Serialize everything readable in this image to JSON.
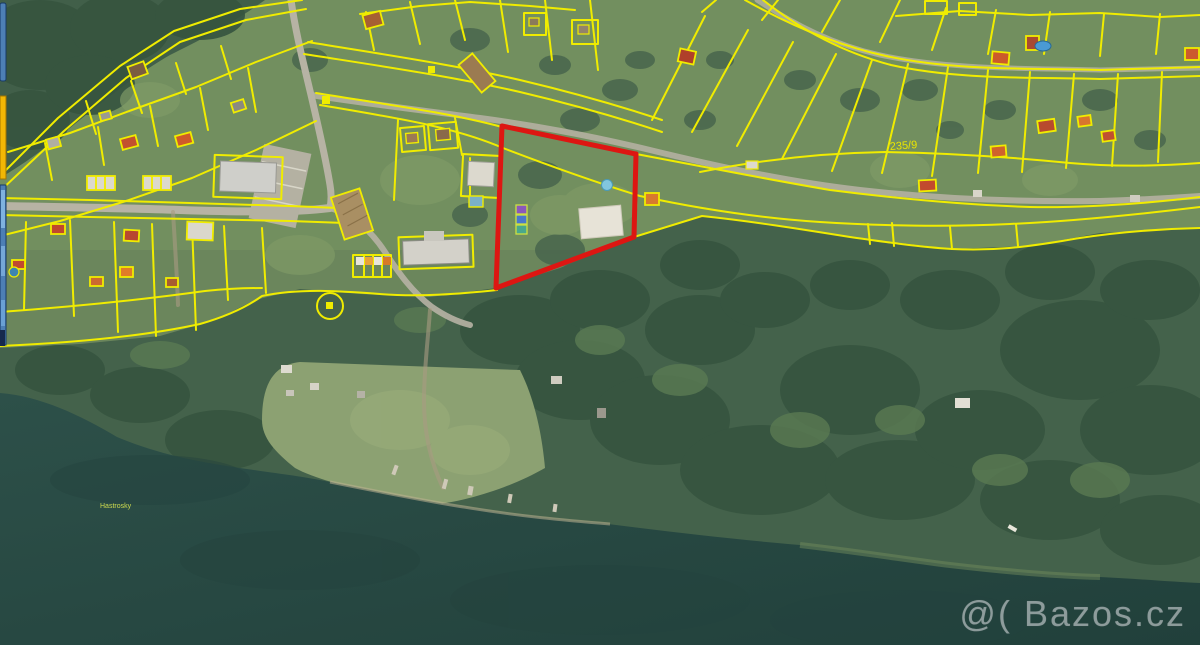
{
  "map": {
    "watermark_text": "@( Bazos.cz",
    "labels": {
      "parcel_number": "235/9",
      "place_name": "Hastrosky"
    },
    "highlight_parcel": {
      "color": "#dd1612",
      "points": "502,126 636,154 634,237 496,288"
    },
    "colors": {
      "cadastral_line": "#f0ec00",
      "water": "#2a4a43",
      "forest": "#44624b",
      "grass": "#66815a",
      "road": "#b7b3a4",
      "watermark": "#ced6d7"
    }
  },
  "ui": {
    "left_edge_panels": [
      {
        "name": "panel-blue-top",
        "color": "#4d7fb5"
      },
      {
        "name": "panel-yellow",
        "color": "#f2b705"
      },
      {
        "name": "panel-blue-bottom",
        "color": "#4d7fb5"
      }
    ]
  }
}
